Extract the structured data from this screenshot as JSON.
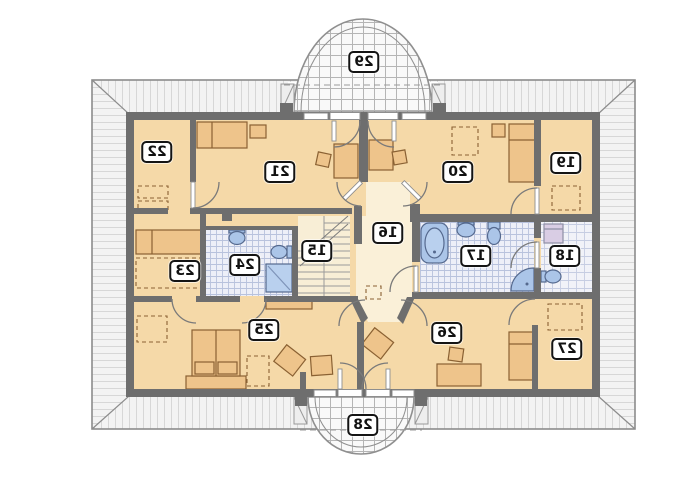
{
  "plan": {
    "description_of_content": "attic floor plan, horizontally mirrored drawing",
    "text_mirrored": true,
    "labels": [
      {
        "id": "room-15",
        "text": "15",
        "x": 317,
        "y": 251
      },
      {
        "id": "room-16",
        "text": "16",
        "x": 388,
        "y": 233
      },
      {
        "id": "room-17",
        "text": "17",
        "x": 476,
        "y": 256
      },
      {
        "id": "room-18",
        "text": "18",
        "x": 565,
        "y": 256
      },
      {
        "id": "room-19",
        "text": "19",
        "x": 566,
        "y": 163
      },
      {
        "id": "room-20",
        "text": "20",
        "x": 458,
        "y": 172
      },
      {
        "id": "room-21",
        "text": "21",
        "x": 280,
        "y": 172
      },
      {
        "id": "room-22",
        "text": "22",
        "x": 157,
        "y": 152
      },
      {
        "id": "room-23",
        "text": "23",
        "x": 185,
        "y": 271
      },
      {
        "id": "room-24",
        "text": "24",
        "x": 245,
        "y": 265
      },
      {
        "id": "room-25",
        "text": "25",
        "x": 264,
        "y": 330
      },
      {
        "id": "room-26",
        "text": "26",
        "x": 447,
        "y": 333
      },
      {
        "id": "room-27",
        "text": "27",
        "x": 567,
        "y": 349
      },
      {
        "id": "balcony-28",
        "text": "28",
        "x": 363,
        "y": 425
      },
      {
        "id": "balcony-29",
        "text": "29",
        "x": 364,
        "y": 62
      }
    ],
    "colors": {
      "wall": "#6e6e6e",
      "floor": "#f5d9a8",
      "hall_floor": "#faf0d8",
      "roof_hatch_bg": "#f3f3f3",
      "roof_line": "#8c8c8c",
      "bath_tile": "#edeff8",
      "fixture_blue": "#abc5e8",
      "furniture": "#eec48b",
      "furniture_line": "#8a6133",
      "washer": "#d9cde4"
    }
  }
}
